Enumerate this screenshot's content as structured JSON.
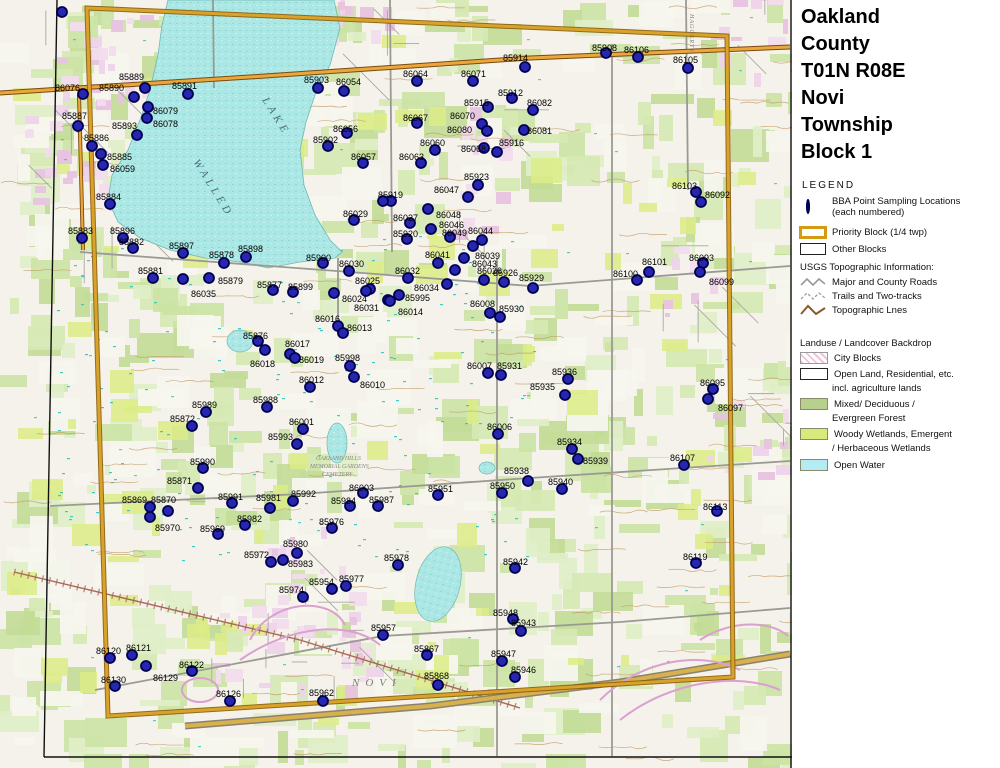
{
  "title": {
    "lines": [
      "Oakland",
      "County",
      "T01N R08E",
      "Novi",
      "Township",
      "Block 1"
    ]
  },
  "legend": {
    "heading": "LEGEND",
    "bba_line1": "BBA Point Sampling Locations",
    "bba_line2": "(each numbered)",
    "priority": "Priority Block (1/4 twp)",
    "other": "Other Blocks",
    "usgs_heading": "USGS Topographic Information:",
    "roads": "Major and County Roads",
    "trails": "Trails and Two-tracks",
    "topo": "Topographic Lnes"
  },
  "landuse": {
    "heading": "Landuse / Landcover Backdrop",
    "city": "City Blocks",
    "open1": "Open Land, Residential, etc.",
    "open2": "incl. agriculture lands",
    "forest1": "Mixed/ Deciduous /",
    "forest2": "Evergreen Forest",
    "wetland1": "Woody Wetlands, Emergent",
    "wetland2": "/ Herbaceous Wetlands",
    "water": "Open Water"
  },
  "logo": {
    "name": "MICHIGAN",
    "subtitle": "Breeding Bird Atlas",
    "years": "2002 - 2007",
    "numeral": "II"
  },
  "north_label": "N",
  "scale_miles": {
    "ticks": [
      "0",
      "0.1",
      "0.2",
      "0.3",
      "0.4",
      "0.5"
    ],
    "unit": "Miles"
  },
  "scale_km": {
    "ticks": [
      "0",
      "0.2",
      "0.4",
      "0.6"
    ],
    "unit": "Kilometers"
  },
  "revision": "(rev. 2005 may 18)",
  "map": {
    "colors": {
      "dot_fill": "#2626b0",
      "dot_ring": "#000050",
      "lake": "#abe7e4",
      "block_border": "#c8860a",
      "forest": "#cbe3a4",
      "wetland": "#dcec86",
      "urban": "#eed3ea",
      "contour": "#bf9760",
      "road_orange": "#eaa83c"
    },
    "map_texts": [
      {
        "text": "WALLED",
        "x": 193,
        "y": 162,
        "rot": 58,
        "size": 11,
        "color": "#4a6e7e",
        "ls": 4
      },
      {
        "text": "LAKE",
        "x": 262,
        "y": 100,
        "rot": 58,
        "size": 11,
        "color": "#4a6e7e",
        "ls": 4
      },
      {
        "text": "NOVI",
        "x": 352,
        "y": 686,
        "rot": 0,
        "size": 11,
        "color": "#7d7d78",
        "ls": 6
      },
      {
        "text": "HAGGERTY",
        "x": 690,
        "y": 14,
        "rot": 90,
        "size": 6,
        "color": "#7d7d78",
        "ls": 1
      },
      {
        "text": "OAKLAND HILLS",
        "x": 316,
        "y": 460,
        "rot": 0,
        "size": 6,
        "color": "#8a8a84",
        "ls": 0
      },
      {
        "text": "MEMORIAL GARDENS",
        "x": 310,
        "y": 468,
        "rot": 0,
        "size": 6,
        "color": "#8a8a84",
        "ls": 0
      },
      {
        "text": "CEMETERY",
        "x": 322,
        "y": 476,
        "rot": 0,
        "size": 6,
        "color": "#8a8a84",
        "ls": 0
      }
    ],
    "points_fields": [
      "id",
      "dot_x",
      "dot_y",
      "label_x",
      "label_baseline_y"
    ],
    "points": [
      [
        "85889",
        145,
        88,
        119,
        80
      ],
      [
        "86076",
        83,
        94,
        55,
        91
      ],
      [
        "85890",
        134,
        97,
        99,
        91
      ],
      [
        "85891",
        188,
        94,
        172,
        89
      ],
      [
        "86079",
        148,
        107,
        153,
        114
      ],
      [
        "86078",
        147,
        118,
        153,
        127
      ],
      [
        "85893",
        137,
        135,
        112,
        129
      ],
      [
        "85887",
        78,
        126,
        62,
        119
      ],
      [
        "85886",
        92,
        146,
        84,
        141
      ],
      [
        "85885",
        101,
        154,
        107,
        160
      ],
      [
        "86059",
        103,
        165,
        110,
        172
      ],
      [
        "85884",
        110,
        204,
        96,
        200
      ],
      [
        "85883",
        82,
        238,
        68,
        234
      ],
      [
        "85896",
        123,
        238,
        110,
        234
      ],
      [
        "85882",
        133,
        248,
        119,
        245
      ],
      [
        "85897",
        183,
        253,
        169,
        249
      ],
      [
        "85878",
        224,
        263,
        209,
        258
      ],
      [
        "85898",
        246,
        257,
        238,
        252
      ],
      [
        "85879",
        209,
        278,
        218,
        284
      ],
      [
        "86035",
        183,
        279,
        191,
        297
      ],
      [
        "85877",
        273,
        290,
        257,
        288
      ],
      [
        "85899",
        293,
        292,
        288,
        290
      ],
      [
        "85900",
        323,
        263,
        306,
        261
      ],
      [
        "85881",
        153,
        278,
        138,
        274
      ],
      [
        "86030",
        349,
        271,
        339,
        267
      ],
      [
        "86025",
        370,
        289,
        355,
        284
      ],
      [
        "86024",
        366,
        291,
        342,
        302
      ],
      [
        "86031",
        388,
        300,
        354,
        311
      ],
      [
        "86032",
        408,
        278,
        395,
        274
      ],
      [
        "86034",
        447,
        284,
        414,
        291
      ],
      [
        "85995",
        399,
        295,
        405,
        301
      ],
      [
        "86014",
        390,
        301,
        398,
        315
      ],
      [
        "86016",
        338,
        326,
        315,
        322
      ],
      [
        "86013",
        343,
        333,
        347,
        331
      ],
      [
        "86017",
        290,
        354,
        285,
        347
      ],
      [
        "86019",
        295,
        358,
        299,
        363
      ],
      [
        "85998",
        350,
        366,
        335,
        361
      ],
      [
        "86012",
        310,
        387,
        299,
        383
      ],
      [
        "86010",
        354,
        377,
        360,
        388
      ],
      [
        "85876",
        258,
        341,
        243,
        339
      ],
      [
        "86018",
        265,
        350,
        250,
        367
      ],
      [
        "85988",
        267,
        407,
        253,
        403
      ],
      [
        "85989",
        206,
        412,
        192,
        408
      ],
      [
        "85872",
        192,
        426,
        170,
        422
      ],
      [
        "85993",
        297,
        444,
        268,
        440
      ],
      [
        "86001",
        303,
        429,
        289,
        425
      ],
      [
        "85990",
        203,
        468,
        190,
        465
      ],
      [
        "85871",
        198,
        488,
        167,
        484
      ],
      [
        "85869",
        150,
        507,
        122,
        503
      ],
      [
        "85870",
        168,
        511,
        151,
        503
      ],
      [
        "85991",
        232,
        503,
        218,
        500
      ],
      [
        "85981",
        270,
        508,
        256,
        501
      ],
      [
        "85970",
        150,
        517,
        155,
        531
      ],
      [
        "85982",
        245,
        525,
        237,
        522
      ],
      [
        "85969",
        218,
        534,
        200,
        532
      ],
      [
        "85972",
        271,
        562,
        244,
        558
      ],
      [
        "85980",
        297,
        553,
        283,
        547
      ],
      [
        "85983",
        283,
        560,
        288,
        567
      ],
      [
        "85974",
        303,
        597,
        279,
        593
      ],
      [
        "85954",
        332,
        589,
        309,
        585
      ],
      [
        "85977",
        346,
        586,
        339,
        582
      ],
      [
        "85976",
        332,
        528,
        319,
        525
      ],
      [
        "85984",
        350,
        506,
        331,
        504
      ],
      [
        "85987",
        378,
        506,
        369,
        503
      ],
      [
        "85992",
        293,
        501,
        291,
        497
      ],
      [
        "86003",
        363,
        493,
        349,
        491
      ],
      [
        "85951",
        438,
        495,
        428,
        492
      ],
      [
        "85950",
        502,
        493,
        490,
        489
      ],
      [
        "85962",
        323,
        701,
        309,
        696
      ],
      [
        "85978",
        398,
        565,
        384,
        561
      ],
      [
        "85957",
        383,
        635,
        371,
        631
      ],
      [
        "85867",
        427,
        655,
        414,
        652
      ],
      [
        "85868",
        438,
        685,
        424,
        679
      ],
      [
        "85948",
        513,
        619,
        493,
        616
      ],
      [
        "85943",
        521,
        631,
        511,
        626
      ],
      [
        "85942",
        515,
        568,
        503,
        565
      ],
      [
        "85947",
        502,
        661,
        491,
        657
      ],
      [
        "85946",
        515,
        677,
        511,
        673
      ],
      [
        "86113",
        717,
        511,
        703,
        510
      ],
      [
        "86119",
        696,
        563,
        683,
        560
      ],
      [
        "86120",
        110,
        658,
        96,
        654
      ],
      [
        "86121",
        132,
        655,
        126,
        651
      ],
      [
        "86122",
        192,
        671,
        179,
        668
      ],
      [
        "86129",
        146,
        666,
        153,
        681
      ],
      [
        "86130",
        115,
        686,
        101,
        683
      ],
      [
        "86126",
        230,
        701,
        216,
        697
      ],
      [
        "85914",
        525,
        67,
        503,
        61
      ],
      [
        "85908",
        606,
        53,
        592,
        51
      ],
      [
        "86106",
        638,
        57,
        624,
        53
      ],
      [
        "86105",
        688,
        68,
        673,
        63
      ],
      [
        "85912",
        512,
        98,
        498,
        96
      ],
      [
        "85915",
        488,
        107,
        464,
        106
      ],
      [
        "86070",
        482,
        124,
        450,
        119
      ],
      [
        "86080",
        487,
        131,
        447,
        133
      ],
      [
        "86082",
        533,
        110,
        527,
        106
      ],
      [
        "86081",
        524,
        130,
        527,
        134
      ],
      [
        "85916",
        497,
        152,
        499,
        146
      ],
      [
        "86068",
        484,
        148,
        461,
        152
      ],
      [
        "86060",
        435,
        150,
        420,
        146
      ],
      [
        "86067",
        417,
        123,
        403,
        121
      ],
      [
        "86064",
        417,
        81,
        403,
        77
      ],
      [
        "86071",
        473,
        81,
        461,
        77
      ],
      [
        "86063",
        421,
        163,
        399,
        160
      ],
      [
        "86057",
        363,
        163,
        351,
        160
      ],
      [
        "86056",
        347,
        133,
        333,
        132
      ],
      [
        "85902",
        328,
        146,
        313,
        143
      ],
      [
        "85903",
        318,
        88,
        304,
        83
      ],
      [
        "86054",
        344,
        91,
        336,
        85
      ],
      [
        "85919",
        383,
        201,
        378,
        198
      ],
      [
        "86029",
        354,
        220,
        343,
        217
      ],
      [
        "86027",
        410,
        223,
        393,
        221
      ],
      [
        "85920",
        407,
        239,
        393,
        237
      ],
      [
        "86047",
        468,
        197,
        434,
        193
      ],
      [
        "85923",
        478,
        185,
        464,
        180
      ],
      [
        "86048",
        428,
        209,
        436,
        218
      ],
      [
        "86046",
        431,
        229,
        439,
        228
      ],
      [
        "86049",
        450,
        237,
        442,
        236
      ],
      [
        "86044",
        482,
        240,
        468,
        234
      ],
      [
        "86041",
        438,
        263,
        425,
        258
      ],
      [
        "86039",
        464,
        258,
        475,
        259
      ],
      [
        "86043",
        455,
        270,
        472,
        267
      ],
      [
        "86026",
        484,
        280,
        477,
        274
      ],
      [
        "85926",
        504,
        282,
        493,
        276
      ],
      [
        "86008",
        490,
        313,
        470,
        307
      ],
      [
        "85930",
        500,
        317,
        499,
        312
      ],
      [
        "85929",
        533,
        288,
        519,
        281
      ],
      [
        "86007",
        488,
        373,
        467,
        369
      ],
      [
        "85931",
        501,
        375,
        497,
        369
      ],
      [
        "86006",
        498,
        434,
        487,
        430
      ],
      [
        "85936",
        568,
        379,
        552,
        375
      ],
      [
        "85935",
        565,
        395,
        530,
        390
      ],
      [
        "86095",
        713,
        389,
        700,
        386
      ],
      [
        "86097",
        708,
        399,
        718,
        411
      ],
      [
        "85934",
        572,
        449,
        557,
        445
      ],
      [
        "85939",
        578,
        459,
        583,
        464
      ],
      [
        "85938",
        528,
        481,
        504,
        474
      ],
      [
        "85940",
        562,
        489,
        548,
        485
      ],
      [
        "86107",
        684,
        465,
        670,
        461
      ],
      [
        "86100",
        637,
        280,
        613,
        277
      ],
      [
        "86101",
        649,
        272,
        642,
        265
      ],
      [
        "86093",
        703,
        263,
        689,
        261
      ],
      [
        "86099",
        700,
        272,
        709,
        285
      ],
      [
        "86103",
        696,
        192,
        672,
        189
      ],
      [
        "86092",
        701,
        202,
        705,
        198
      ]
    ],
    "extra_dots": [
      [
        62,
        12
      ],
      [
        473,
        246
      ],
      [
        334,
        293
      ],
      [
        391,
        201
      ]
    ]
  }
}
